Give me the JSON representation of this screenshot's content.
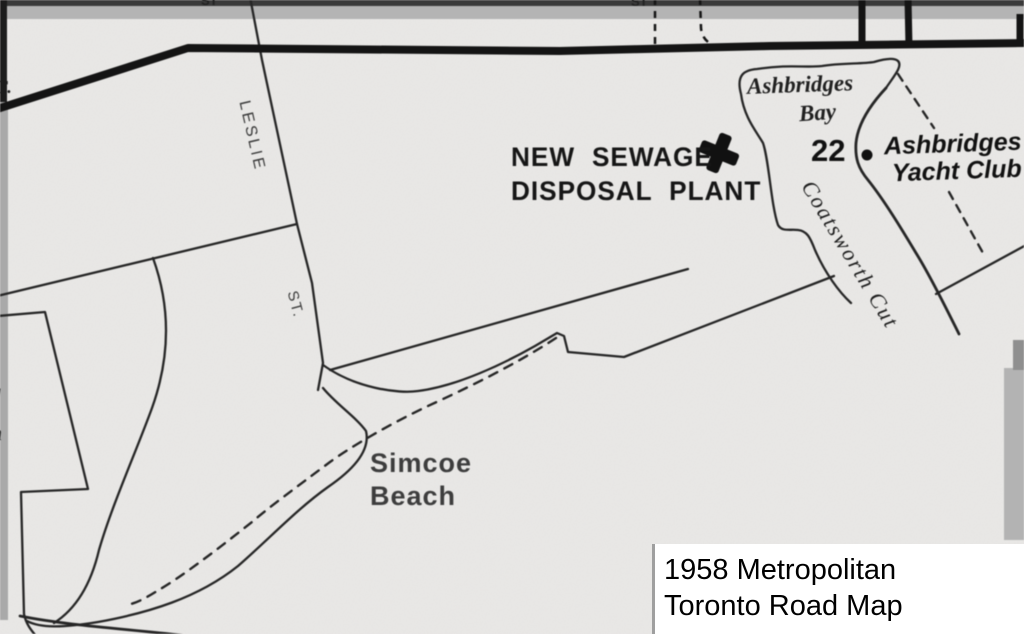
{
  "map": {
    "labels": {
      "plant_line1": "NEW SEWAGE",
      "plant_line2": "DISPOSAL PLANT",
      "bay_line1": "Ashbridges",
      "bay_line2": "Bay",
      "route_number": "22",
      "yacht_line1": "Ashbridges",
      "yacht_line2": "Yacht Club",
      "channel": "Coatsworth Cut",
      "street": "LESLIE",
      "street_suffix": "ST.",
      "beach_line1": "Simcoe",
      "beach_line2": "Beach"
    },
    "fragments": {
      "left_top": "T.",
      "left_mid": "g",
      "left_lower": "n",
      "top_a": "ST",
      "top_b": "ST"
    },
    "icons": {
      "sewage_plant_cross": "plus-cross",
      "yacht_club_marker": "dot"
    },
    "caption": {
      "line1": "1958 Metropolitan",
      "line2": "Toronto Road Map"
    },
    "colors": {
      "background": "#e9e8e6",
      "thin_line": "#262626",
      "thick_road": "#141414",
      "top_band_gray": "#b4b4b4",
      "edge_strip_gray": "#a9a9a9",
      "caption_bg": "#ffffff",
      "caption_text": "#000000"
    }
  }
}
